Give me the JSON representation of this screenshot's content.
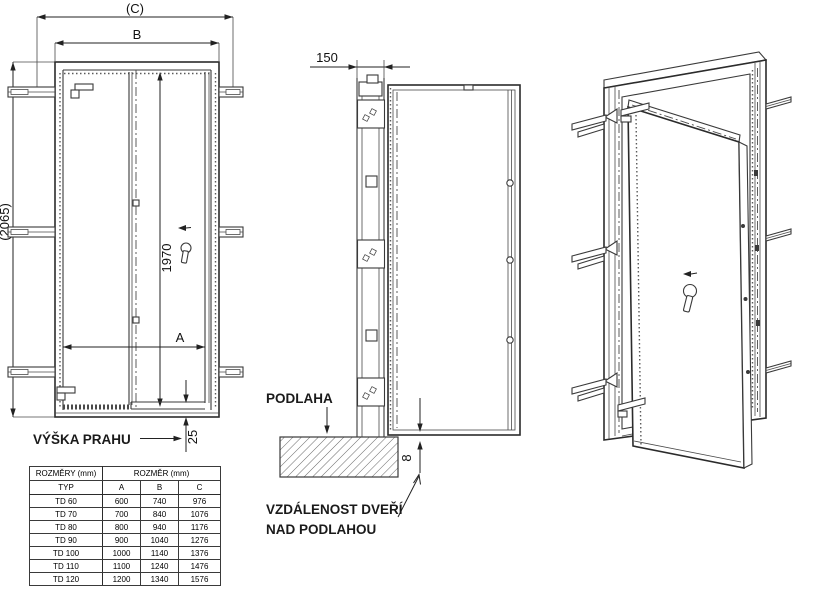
{
  "drawing": {
    "front_view": {
      "dim_overall_width": "(C)",
      "dim_frame_width": "B",
      "dim_overall_height": "(2065)",
      "dim_leaf_height": "1970",
      "dim_leaf_width": "A",
      "dim_threshold_height": "25",
      "threshold_label": "VÝŠKA PRAHU"
    },
    "side_view": {
      "dim_frame_depth": "150",
      "floor_label": "PODLAHA",
      "dim_floor_gap": "8",
      "gap_label_line1": "VZDÁLENOST DVEŘÍ",
      "gap_label_line2": "NAD PODLAHOU"
    }
  },
  "table": {
    "header_group_left": "ROZMĚRY (mm)",
    "header_group_right": "ROZMĚR (mm)",
    "columns": [
      "TYP",
      "A",
      "B",
      "C"
    ],
    "rows": [
      {
        "typ": "TD 60",
        "a": "600",
        "b": "740",
        "c": "976"
      },
      {
        "typ": "TD 70",
        "a": "700",
        "b": "840",
        "c": "1076"
      },
      {
        "typ": "TD 80",
        "a": "800",
        "b": "940",
        "c": "1176"
      },
      {
        "typ": "TD 90",
        "a": "900",
        "b": "1040",
        "c": "1276"
      },
      {
        "typ": "TD 100",
        "a": "1000",
        "b": "1140",
        "c": "1376"
      },
      {
        "typ": "TD 110",
        "a": "1100",
        "b": "1240",
        "c": "1476"
      },
      {
        "typ": "TD 120",
        "a": "1200",
        "b": "1340",
        "c": "1576"
      }
    ]
  },
  "colors": {
    "line": "#3a3a3a",
    "text": "#111111",
    "background": "#ffffff"
  }
}
